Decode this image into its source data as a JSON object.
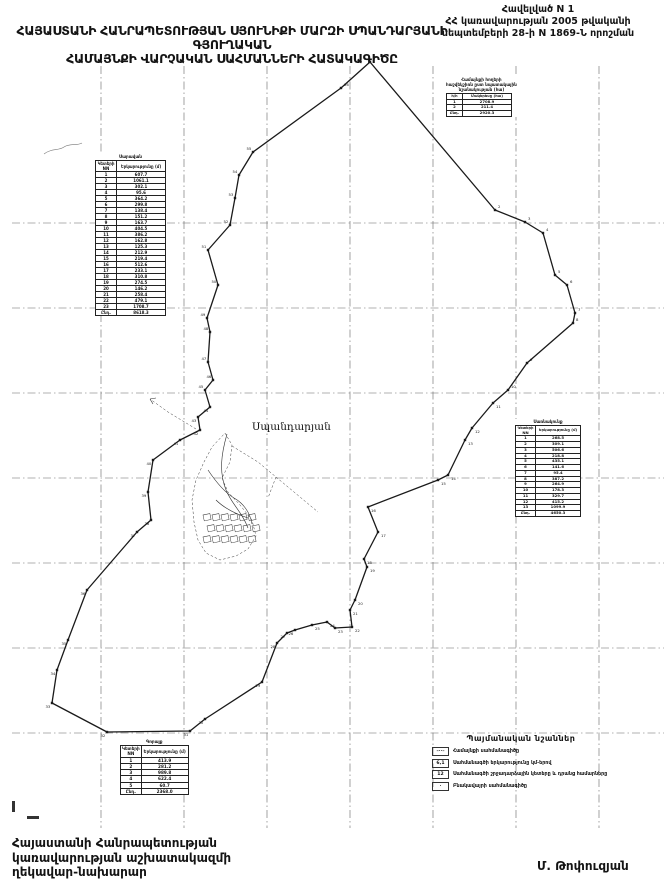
{
  "header": {
    "title_line1": "ՀԱՅԱՍՏԱՆԻ ՀԱՆՐԱՊԵՏՈՒԹՅԱՆ ՍՅՈՒՆԻՔԻ ՄԱՐԶԻ ՍՊԱՆԴԱՐՅԱՆԻ ԳՅՈՒՂԱԿԱՆ",
    "title_line2": "ՀԱՄԱՅՆՔԻ ՎԱՐՉԱԿԱՆ ՍԱՀՄԱՆՆԵՐԻ ՀԱՏԱԿԱԳԻԾԸ",
    "annex_line1": "Հավելված N 1",
    "annex_line2": "ՀՀ կառավարության 2005 թվականի",
    "annex_line3": "սեպտեմբերի 28-ի N 1869-Ն որոշման"
  },
  "footer": {
    "official_line1": "Հայաստանի Հանրապետության",
    "official_line2": "կառավարության աշխատակազմի",
    "official_line3": "ղեկավար-նախարար",
    "signature": "Մ. Թոփուզյան"
  },
  "map": {
    "settlement_label": "Սպանդարյան",
    "colors": {
      "ink": "#1a1a1a",
      "grid": "#666666"
    },
    "grid_x": [
      101,
      184,
      267,
      350,
      433,
      516,
      599
    ],
    "grid_y": [
      223,
      308,
      393,
      478,
      563,
      648,
      733
    ],
    "boundary_points": [
      [
        370,
        62
      ],
      [
        495,
        210
      ],
      [
        525,
        222
      ],
      [
        543,
        233
      ],
      [
        555,
        275
      ],
      [
        567,
        285
      ],
      [
        575,
        313
      ],
      [
        573,
        323
      ],
      [
        527,
        363
      ],
      [
        508,
        390
      ],
      [
        493,
        403
      ],
      [
        472,
        428
      ],
      [
        465,
        440
      ],
      [
        448,
        475
      ],
      [
        438,
        480
      ],
      [
        368,
        507
      ],
      [
        378,
        532
      ],
      [
        364,
        559
      ],
      [
        367,
        567
      ],
      [
        355,
        600
      ],
      [
        350,
        610
      ],
      [
        352,
        627
      ],
      [
        335,
        628
      ],
      [
        327,
        622
      ],
      [
        312,
        625
      ],
      [
        295,
        630
      ],
      [
        287,
        633
      ],
      [
        277,
        643
      ],
      [
        262,
        682
      ],
      [
        205,
        719
      ],
      [
        190,
        731
      ],
      [
        107,
        732
      ],
      [
        52,
        703
      ],
      [
        57,
        670
      ],
      [
        68,
        640
      ],
      [
        87,
        590
      ],
      [
        137,
        532
      ],
      [
        151,
        520
      ],
      [
        148,
        492
      ],
      [
        153,
        460
      ],
      [
        180,
        440
      ],
      [
        200,
        430
      ],
      [
        198,
        417
      ],
      [
        210,
        407
      ],
      [
        205,
        390
      ],
      [
        213,
        380
      ],
      [
        208,
        362
      ],
      [
        210,
        332
      ],
      [
        207,
        318
      ],
      [
        218,
        285
      ],
      [
        208,
        250
      ],
      [
        230,
        225
      ],
      [
        235,
        198
      ],
      [
        239,
        175
      ],
      [
        253,
        152
      ],
      [
        341,
        88
      ]
    ]
  },
  "tables": {
    "left_segments": {
      "x": 95,
      "y": 154,
      "f": 4,
      "col_w": [
        18,
        46
      ],
      "caption_lines": [
        "Սարավան"
      ],
      "headers": [
        "Կետերի NN",
        "Երկարությունը (մ)"
      ],
      "rows": [
        [
          "1",
          "607.7"
        ],
        [
          "2",
          "1061.1"
        ],
        [
          "3",
          "302.1"
        ],
        [
          "4",
          "95.6"
        ],
        [
          "5",
          "364.2"
        ],
        [
          "6",
          "299.8"
        ],
        [
          "7",
          "138.4"
        ],
        [
          "8",
          "151.2"
        ],
        [
          "9",
          "163.7"
        ],
        [
          "10",
          "404.5"
        ],
        [
          "11",
          "386.2"
        ],
        [
          "12",
          "162.8"
        ],
        [
          "13",
          "125.3"
        ],
        [
          "14",
          "212.9"
        ],
        [
          "15",
          "219.4"
        ],
        [
          "16",
          "512.6"
        ],
        [
          "17",
          "233.1"
        ],
        [
          "18",
          "310.8"
        ],
        [
          "19",
          "274.5"
        ],
        [
          "20",
          "146.2"
        ],
        [
          "21",
          "258.4"
        ],
        [
          "22",
          "479.1"
        ],
        [
          "23",
          "1708.7"
        ]
      ],
      "total": [
        "Ընդ.",
        "8618.3"
      ]
    },
    "right_segments": {
      "x": 515,
      "y": 419,
      "f": 3.8,
      "col_w": [
        17,
        42
      ],
      "caption_lines": [
        "Սառնակունք"
      ],
      "headers": [
        "Կետերի NN",
        "Երկարությունը (մ)"
      ],
      "rows": [
        [
          "1",
          "268.5"
        ],
        [
          "2",
          "309.1"
        ],
        [
          "3",
          "506.6"
        ],
        [
          "4",
          "218.8"
        ],
        [
          "5",
          "435.1"
        ],
        [
          "6",
          "141.6"
        ],
        [
          "7",
          "95.4"
        ],
        [
          "8",
          "387.2"
        ],
        [
          "9",
          "264.9"
        ],
        [
          "10",
          "178.3"
        ],
        [
          "11",
          "329.7"
        ],
        [
          "12",
          "415.2"
        ],
        [
          "13",
          "1099.9"
        ]
      ],
      "total": [
        "Ընդ.",
        "4650.3"
      ]
    },
    "bottom_segments": {
      "x": 120,
      "y": 739,
      "f": 4.2,
      "col_w": [
        16,
        44
      ],
      "caption_lines": [
        "Գորայք"
      ],
      "headers": [
        "Կետերի NN",
        "Երկարությունը (մ)"
      ],
      "rows": [
        [
          "1",
          "413.9"
        ],
        [
          "2",
          "281.2"
        ],
        [
          "3",
          "989.8"
        ],
        [
          "4",
          "622.4"
        ],
        [
          "5",
          "60.7"
        ]
      ],
      "total": [
        "Ընդ.",
        "2368.0"
      ]
    },
    "landuse": {
      "x": 446,
      "y": 77,
      "f": 3.8,
      "col_w": [
        13,
        46
      ],
      "caption_lines": [
        "Համայնքի հողերի",
        "հաշվեկշիռն ըստ նպատակային",
        "նշանակության (հա)"
      ],
      "headers": [
        "հ/հ",
        "Մակերեսը (հա)"
      ],
      "rows": [
        [
          "1",
          "2708.9"
        ],
        [
          "2",
          "211.4"
        ]
      ],
      "total": [
        "Ընդ.",
        "2920.3"
      ]
    }
  },
  "legend": {
    "title": "Պայմանական նշաններ",
    "items": [
      {
        "symbol": "–··–",
        "label": "Համայնքի սահմանագիծը"
      },
      {
        "symbol": "6,1",
        "label": "Սահմանագծի երկարությունը կմ-երով"
      },
      {
        "symbol": "12",
        "label": "Սահմանագծի շրջադարձային կետերը և դրանց համարները"
      },
      {
        "symbol": "·",
        "label": "Բնակավայրի սահմանագիծը"
      }
    ]
  }
}
